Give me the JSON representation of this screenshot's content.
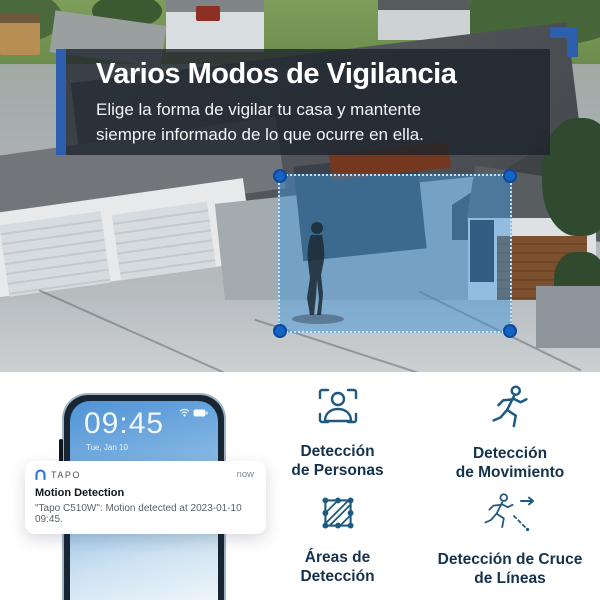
{
  "banner": {
    "title": "Varios Modos de Vigilancia",
    "subtitle_line1": "Elige la forma de vigilar tu casa y mantente",
    "subtitle_line2": "siempre informado de lo que ocurre en ella.",
    "accent_color": "#2e5fae"
  },
  "detection_overlay": {
    "fill_color": "rgba(64,150,220,0.48)",
    "corner_dot_color": "#1565c0"
  },
  "phone": {
    "time": "09:45",
    "date": "Tue, Jan 10",
    "status_icons": [
      "wifi-icon",
      "battery-icon"
    ]
  },
  "notification": {
    "app_icon": "tapo-logo-icon",
    "app_name": "TAPO",
    "timestamp": "now",
    "title": "Motion Detection",
    "body": "\"Tapo C510W\": Motion detected at 2023-01-10 09:45."
  },
  "features": [
    {
      "icon": "person-detection-icon",
      "label_line1": "Detección",
      "label_line2": "de Personas"
    },
    {
      "icon": "motion-detection-icon",
      "label_line1": "Detección",
      "label_line2": "de Movimiento"
    },
    {
      "icon": "detection-areas-icon",
      "label_line1": "Áreas de",
      "label_line2": "Detección"
    },
    {
      "icon": "line-crossing-icon",
      "label_line1": "Detección de Cruce",
      "label_line2": "de Líneas"
    }
  ],
  "colors": {
    "icon_color": "#1e5a80",
    "feature_label_color": "#14324d",
    "banner_overlay": "rgba(28,35,44,0.78)"
  }
}
